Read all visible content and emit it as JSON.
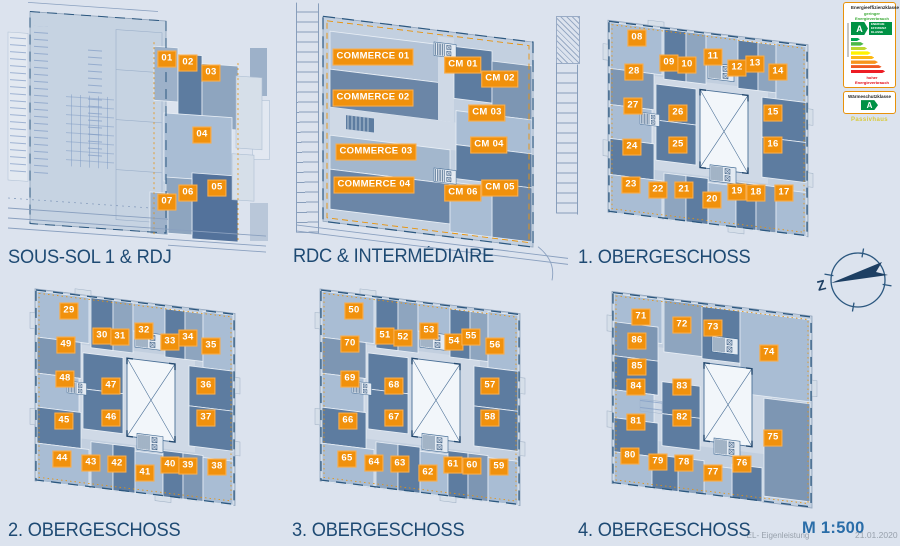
{
  "sheet": {
    "background": "#dce3ee",
    "accent_orange": "#f1910c",
    "title_color": "#1e4a73"
  },
  "plans": [
    {
      "title": "SOUS-SOL 1 & RDJ",
      "units": [
        {
          "label": "01",
          "x": 159,
          "y": 57
        },
        {
          "label": "02",
          "x": 180,
          "y": 61
        },
        {
          "label": "03",
          "x": 203,
          "y": 71
        },
        {
          "label": "04",
          "x": 194,
          "y": 133
        },
        {
          "label": "05",
          "x": 209,
          "y": 186
        },
        {
          "label": "06",
          "x": 180,
          "y": 191
        },
        {
          "label": "07",
          "x": 159,
          "y": 200
        }
      ]
    },
    {
      "title": "RDC & INTERMÉDIAIRE",
      "units": [
        {
          "label": "COMMERCE 01",
          "x": 85,
          "y": 57
        },
        {
          "label": "COMMERCE 02",
          "x": 85,
          "y": 98
        },
        {
          "label": "COMMERCE 03",
          "x": 88,
          "y": 152
        },
        {
          "label": "COMMERCE 04",
          "x": 86,
          "y": 185
        },
        {
          "label": "CM 01",
          "x": 175,
          "y": 65
        },
        {
          "label": "CM 02",
          "x": 212,
          "y": 79
        },
        {
          "label": "CM 03",
          "x": 199,
          "y": 113
        },
        {
          "label": "CM 04",
          "x": 201,
          "y": 145
        },
        {
          "label": "CM 05",
          "x": 212,
          "y": 188
        },
        {
          "label": "CM 06",
          "x": 175,
          "y": 193
        }
      ]
    },
    {
      "title": "1. OBERGESCHOSS",
      "units": [
        {
          "label": "08",
          "x": 47,
          "y": 28
        },
        {
          "label": "09",
          "x": 79,
          "y": 53
        },
        {
          "label": "10",
          "x": 97,
          "y": 55
        },
        {
          "label": "11",
          "x": 123,
          "y": 47
        },
        {
          "label": "12",
          "x": 147,
          "y": 58
        },
        {
          "label": "13",
          "x": 165,
          "y": 54
        },
        {
          "label": "14",
          "x": 188,
          "y": 62
        },
        {
          "label": "15",
          "x": 183,
          "y": 103
        },
        {
          "label": "16",
          "x": 183,
          "y": 135
        },
        {
          "label": "17",
          "x": 194,
          "y": 183
        },
        {
          "label": "18",
          "x": 166,
          "y": 183
        },
        {
          "label": "19",
          "x": 147,
          "y": 182
        },
        {
          "label": "20",
          "x": 122,
          "y": 190
        },
        {
          "label": "21",
          "x": 94,
          "y": 180
        },
        {
          "label": "22",
          "x": 68,
          "y": 180
        },
        {
          "label": "23",
          "x": 41,
          "y": 175
        },
        {
          "label": "24",
          "x": 42,
          "y": 137
        },
        {
          "label": "25",
          "x": 88,
          "y": 135
        },
        {
          "label": "26",
          "x": 88,
          "y": 103
        },
        {
          "label": "27",
          "x": 43,
          "y": 96
        },
        {
          "label": "28",
          "x": 44,
          "y": 62
        }
      ]
    },
    {
      "title": "2. OBERGESCHOSS",
      "units": [
        {
          "label": "29",
          "x": 41,
          "y": 26
        },
        {
          "label": "30",
          "x": 74,
          "y": 51
        },
        {
          "label": "31",
          "x": 92,
          "y": 52
        },
        {
          "label": "32",
          "x": 116,
          "y": 46
        },
        {
          "label": "33",
          "x": 142,
          "y": 57
        },
        {
          "label": "34",
          "x": 160,
          "y": 53
        },
        {
          "label": "35",
          "x": 183,
          "y": 61
        },
        {
          "label": "36",
          "x": 178,
          "y": 101
        },
        {
          "label": "37",
          "x": 178,
          "y": 133
        },
        {
          "label": "38",
          "x": 189,
          "y": 182
        },
        {
          "label": "39",
          "x": 160,
          "y": 181
        },
        {
          "label": "40",
          "x": 142,
          "y": 180
        },
        {
          "label": "41",
          "x": 117,
          "y": 188
        },
        {
          "label": "42",
          "x": 89,
          "y": 179
        },
        {
          "label": "43",
          "x": 63,
          "y": 178
        },
        {
          "label": "44",
          "x": 34,
          "y": 174
        },
        {
          "label": "45",
          "x": 36,
          "y": 136
        },
        {
          "label": "46",
          "x": 83,
          "y": 133
        },
        {
          "label": "47",
          "x": 83,
          "y": 101
        },
        {
          "label": "48",
          "x": 37,
          "y": 94
        },
        {
          "label": "49",
          "x": 38,
          "y": 60
        }
      ]
    },
    {
      "title": "3. OBERGESCHOSS",
      "units": [
        {
          "label": "50",
          "x": 42,
          "y": 26
        },
        {
          "label": "51",
          "x": 73,
          "y": 51
        },
        {
          "label": "52",
          "x": 91,
          "y": 53
        },
        {
          "label": "53",
          "x": 117,
          "y": 46
        },
        {
          "label": "54",
          "x": 142,
          "y": 57
        },
        {
          "label": "55",
          "x": 159,
          "y": 52
        },
        {
          "label": "56",
          "x": 183,
          "y": 61
        },
        {
          "label": "57",
          "x": 178,
          "y": 101
        },
        {
          "label": "58",
          "x": 178,
          "y": 133
        },
        {
          "label": "59",
          "x": 187,
          "y": 182
        },
        {
          "label": "60",
          "x": 160,
          "y": 181
        },
        {
          "label": "61",
          "x": 141,
          "y": 180
        },
        {
          "label": "62",
          "x": 116,
          "y": 188
        },
        {
          "label": "63",
          "x": 88,
          "y": 179
        },
        {
          "label": "64",
          "x": 62,
          "y": 178
        },
        {
          "label": "65",
          "x": 35,
          "y": 174
        },
        {
          "label": "66",
          "x": 36,
          "y": 136
        },
        {
          "label": "67",
          "x": 82,
          "y": 133
        },
        {
          "label": "68",
          "x": 82,
          "y": 101
        },
        {
          "label": "69",
          "x": 38,
          "y": 94
        },
        {
          "label": "70",
          "x": 38,
          "y": 59
        }
      ]
    },
    {
      "title": "4. OBERGESCHOSS",
      "units": [
        {
          "label": "71",
          "x": 33,
          "y": 29
        },
        {
          "label": "72",
          "x": 74,
          "y": 37
        },
        {
          "label": "73",
          "x": 105,
          "y": 40
        },
        {
          "label": "74",
          "x": 161,
          "y": 65
        },
        {
          "label": "75",
          "x": 165,
          "y": 150
        },
        {
          "label": "76",
          "x": 134,
          "y": 176
        },
        {
          "label": "77",
          "x": 105,
          "y": 185
        },
        {
          "label": "78",
          "x": 76,
          "y": 175
        },
        {
          "label": "79",
          "x": 50,
          "y": 174
        },
        {
          "label": "80",
          "x": 22,
          "y": 168
        },
        {
          "label": "81",
          "x": 28,
          "y": 134
        },
        {
          "label": "82",
          "x": 74,
          "y": 130
        },
        {
          "label": "83",
          "x": 74,
          "y": 99
        },
        {
          "label": "84",
          "x": 28,
          "y": 99
        },
        {
          "label": "85",
          "x": 29,
          "y": 79
        },
        {
          "label": "86",
          "x": 29,
          "y": 53
        }
      ]
    }
  ],
  "energy_badge": {
    "efficiency_title": "Energieeffizienzklasse",
    "low_label": "geringer Energieverbrauch",
    "high_label": "hoher Energieverbrauch",
    "class_letter": "A",
    "class_text": "ENERGIE EFFIZIENZ KLASSE",
    "bar_colors": [
      "#00a650",
      "#4cb848",
      "#bfd730",
      "#fff200",
      "#fdb913",
      "#f7941d",
      "#f05a22",
      "#ed1c24"
    ],
    "insulation_title": "Wärmeschutzklasse",
    "insulation_class": "A",
    "passive_label": "Passivhaus"
  },
  "compass": {
    "letter": "Z"
  },
  "footer": {
    "note": "-EL- Eigenleistung",
    "scale": "M 1:500",
    "date": "21.01.2020"
  }
}
